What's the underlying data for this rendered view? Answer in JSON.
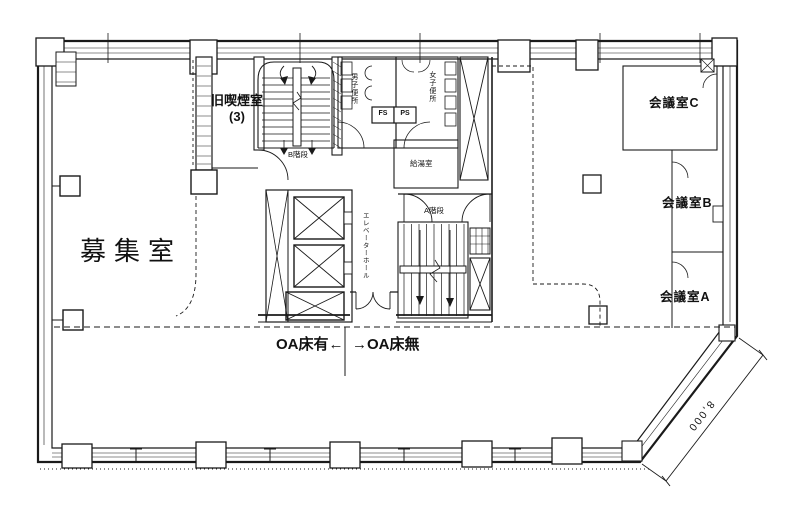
{
  "plan": {
    "background": "#ffffff",
    "line_color": "#1a1a1a",
    "labels": {
      "main_room": "募集室",
      "smoking_room": "旧喫煙室",
      "smoking_room_count": "(3)",
      "meeting_c": "会議室C",
      "meeting_b": "会議室B",
      "meeting_a": "会議室A",
      "stair_b": "B階段",
      "stair_a": "A階段",
      "mens_wc": "男子便所",
      "womens_wc": "女子便所",
      "fs": "FS",
      "ps": "PS",
      "kitchenette": "給湯室",
      "elevator_hall": "エレベーターホール",
      "oa_floor_yes": "OA床有←",
      "oa_floor_no": "→OA床無",
      "dim_8000": "8,000"
    }
  }
}
